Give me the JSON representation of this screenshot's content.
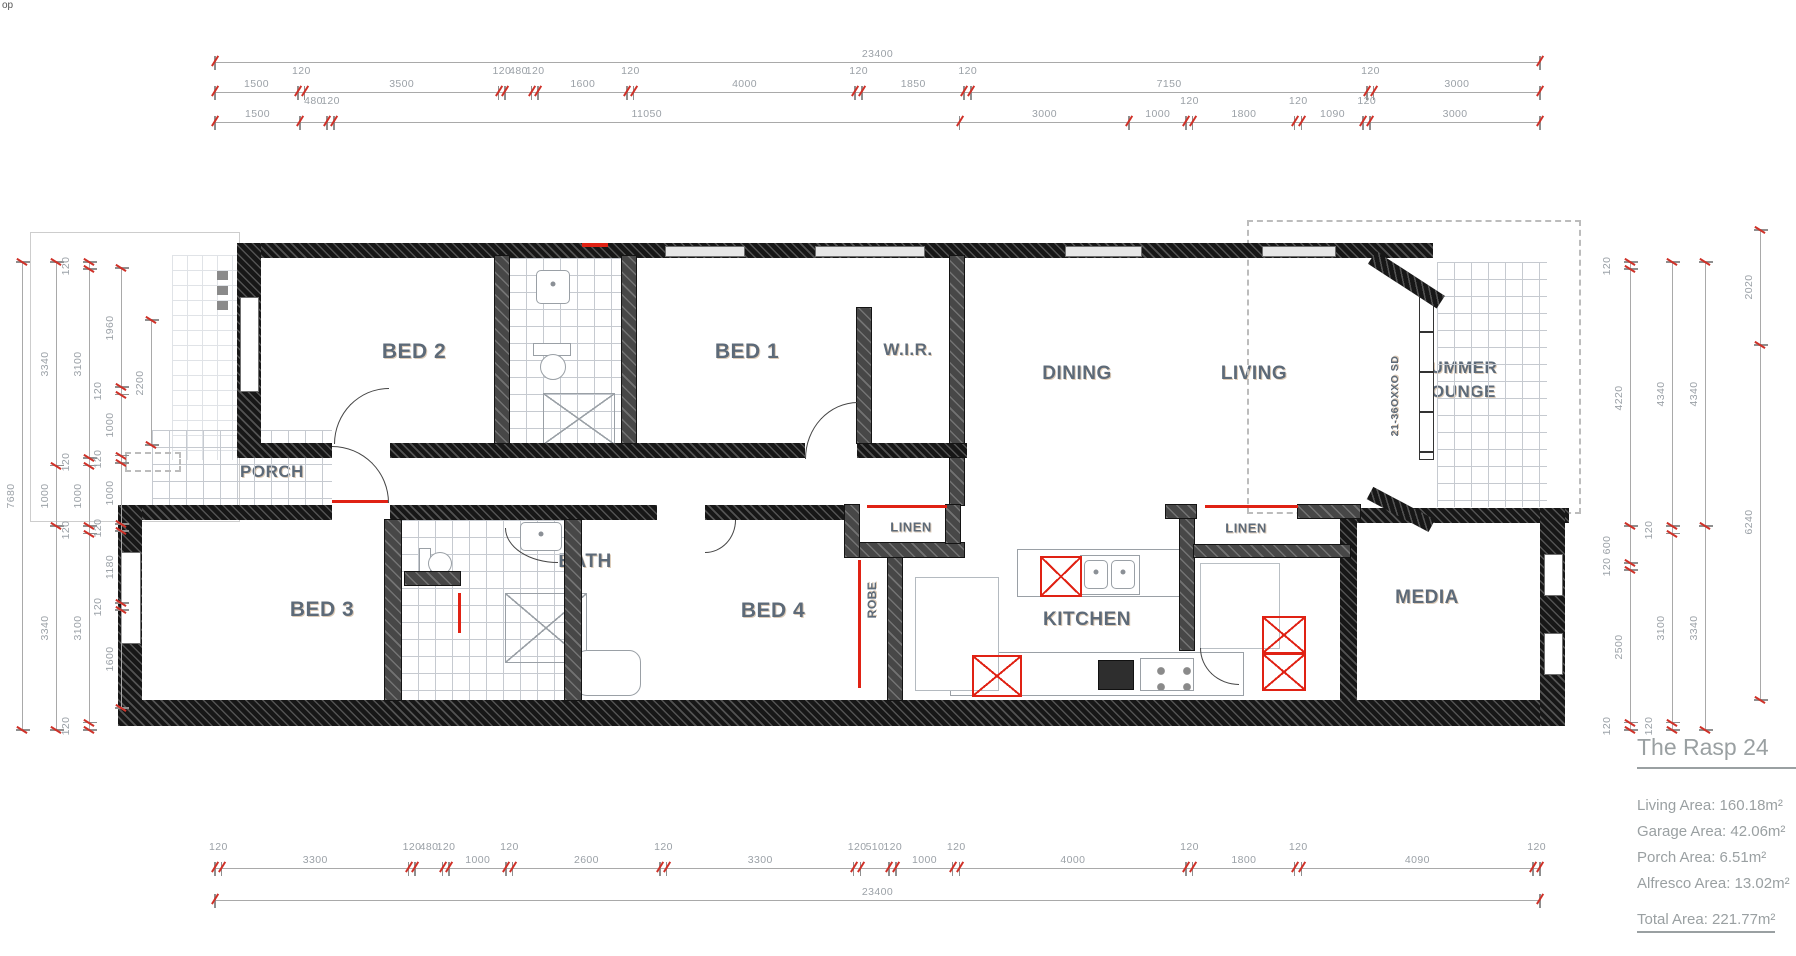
{
  "page": {
    "corner_text": "op"
  },
  "plan": {
    "rooms": {
      "bed2": "BED 2",
      "bed1": "BED 1",
      "wir": "W.I.R.",
      "dining": "DINING",
      "living": "LIVING",
      "summer_lounge_line1": "SUMMER",
      "summer_lounge_line2": "LOUNGE",
      "porch": "PORCH",
      "bed3": "BED 3",
      "bath": "BATH",
      "bed4": "BED 4",
      "robe": "ROBE",
      "wip": "W.I.P.",
      "kitchen": "KITCHEN",
      "ldy": "L'DY",
      "linen_a": "LINEN",
      "linen_b": "LINEN",
      "media": "MEDIA"
    },
    "door_code": "21-36OXXO SD"
  },
  "dimensions": {
    "top": {
      "row1": [
        "23400"
      ],
      "row2": [
        "1500",
        "120",
        "3500",
        "120",
        "480",
        "120",
        "1600",
        "120",
        "4000",
        "120",
        "1850",
        "120",
        "7150",
        "120",
        "3000"
      ],
      "row3": [
        "1500",
        "480",
        "120",
        "11050",
        "3000",
        "1000",
        "120",
        "1800",
        "120",
        "1090",
        "120",
        "3000"
      ]
    },
    "bottom": {
      "row1": [
        "120",
        "3300",
        "120",
        "480",
        "120",
        "1000",
        "120",
        "2600",
        "120",
        "3300",
        "120",
        "510",
        "120",
        "1000",
        "120",
        "4000",
        "120",
        "1800",
        "120",
        "4090",
        "120"
      ],
      "row2": [
        "23400"
      ]
    },
    "left": {
      "chain1": [
        "7680"
      ],
      "chain2": [
        "3340",
        "1000",
        "3340"
      ],
      "chain3": [
        "120",
        "3100",
        "120",
        "1000",
        "120",
        "3100",
        "120"
      ],
      "chain4": [
        "1960",
        "120",
        "1000",
        "120",
        "1000",
        "120",
        "1180",
        "120",
        "1600"
      ],
      "chain5": [
        "2200"
      ]
    },
    "right": {
      "chain1": [
        "120",
        "4220",
        "600",
        "120",
        "2500",
        "120"
      ],
      "chain2": [
        "4340",
        "120",
        "3100",
        "120"
      ],
      "chain3": [
        "4340",
        "3340"
      ],
      "chain4": [
        "2020",
        "6240"
      ]
    }
  },
  "title_block": {
    "title": "The Rasp 24",
    "lines": [
      "Living Area: 160.18m²",
      "Garage Area: 42.06m²",
      "Porch Area: 6.51m²",
      "Alfresco Area: 13.02m²"
    ],
    "total": "Total Area: 221.77m²"
  },
  "colors": {
    "wall": "#171717",
    "partition": "#474747",
    "accent_red": "#e02214",
    "room_label": "#5d6a78",
    "dimension": "#9ba1a7",
    "tile": "#c6cad0",
    "title_text": "#9aa0a2"
  }
}
